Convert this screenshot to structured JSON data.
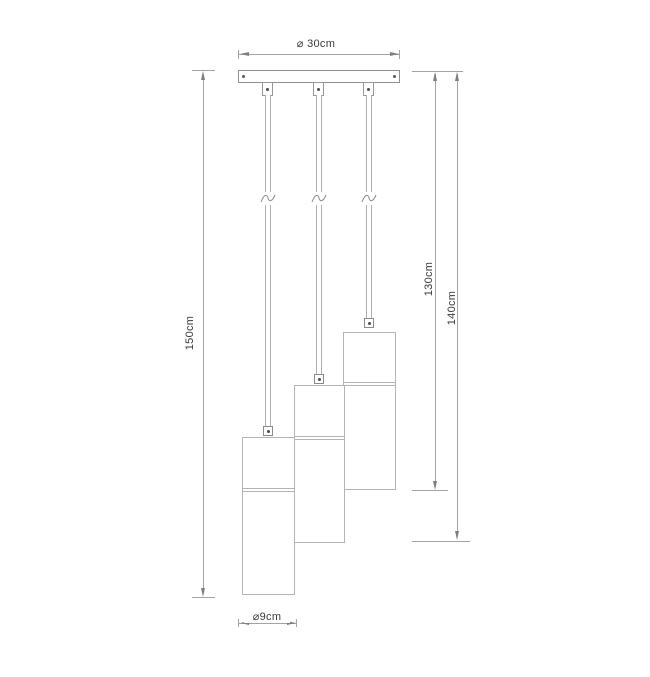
{
  "diagram": {
    "type": "pendant-lamp-dimension-drawing",
    "labels": {
      "canopy_diameter": "⌀ 30cm",
      "total_drop": "150cm",
      "short_drop": "130cm",
      "mid_drop": "140cm",
      "shade_diameter": "⌀9cm"
    },
    "colors": {
      "line": "#a3a3a3",
      "outline": "#8f8f8f",
      "shade_outline": "#b4b4b4",
      "text": "#3a3a3a",
      "background": "#ffffff"
    }
  }
}
